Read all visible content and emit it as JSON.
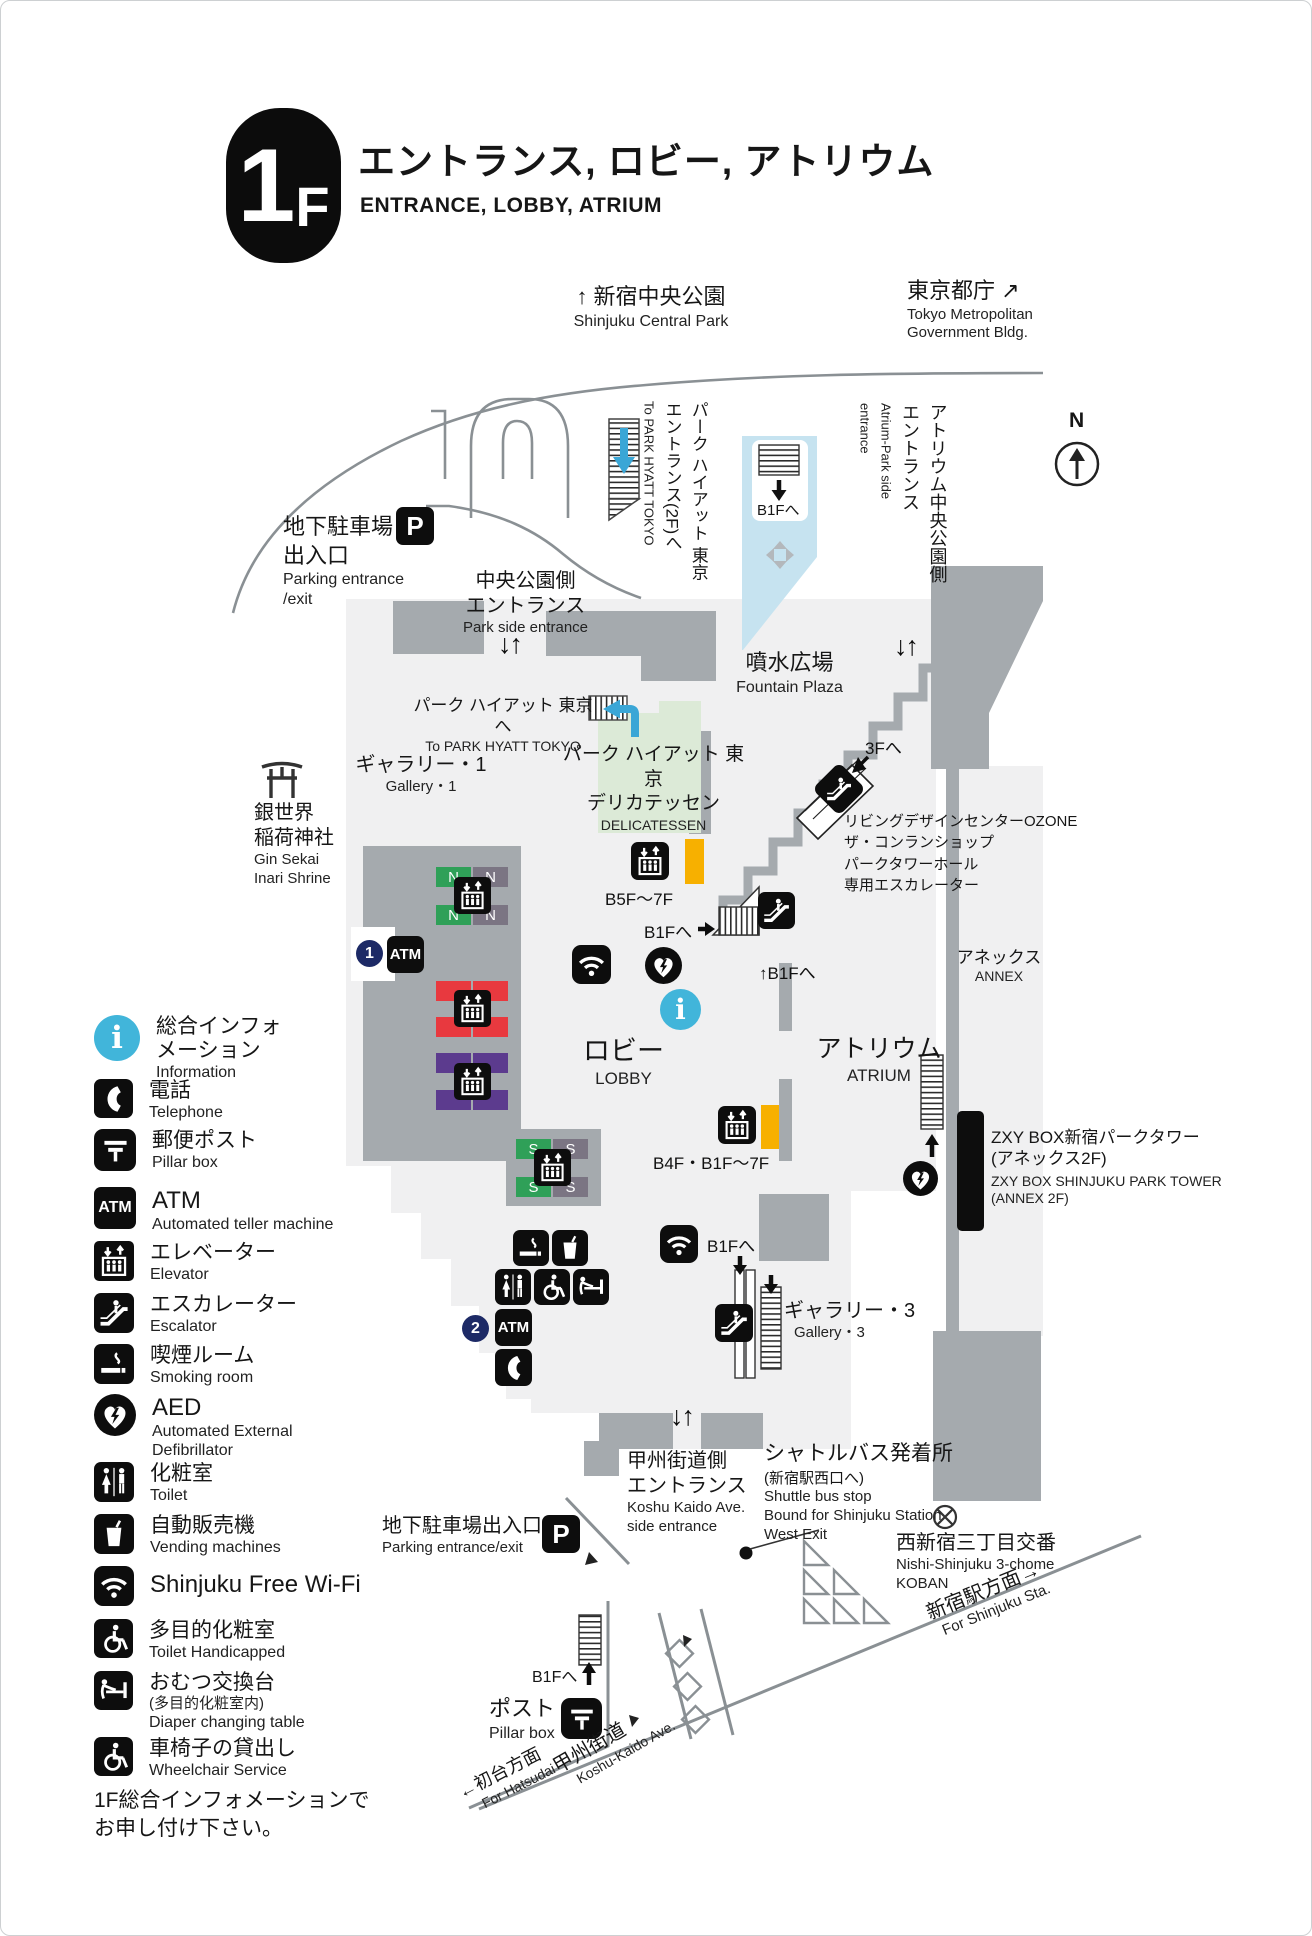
{
  "header": {
    "floor": "1F",
    "title_jp": "エントランス, ロビー, アトリウム",
    "title_en": "ENTRANCE, LOBBY, ATRIUM"
  },
  "compass": {
    "label": "N"
  },
  "top": {
    "park_jp": "↑ 新宿中央公園",
    "park_en": "Shinjuku Central Park",
    "tmg_jp": "東京都庁 ↗",
    "tmg_en1": "Tokyo Metropolitan",
    "tmg_en2": "Government Bldg."
  },
  "map": {
    "sym": {
      "p": "P",
      "atm": "ATM",
      "n": "N",
      "s": "S",
      "one": "1",
      "two": "2",
      "i": "i",
      "arrows": "↓↑",
      "right": "→",
      "up": "↑"
    },
    "parking_top": {
      "jp1": "地下駐車場",
      "jp2": "出入口",
      "en1": "Parking entrance",
      "en2": "/exit"
    },
    "park_side": {
      "jp1": "中央公園側",
      "jp2": "エントランス",
      "en": "Park side entrance"
    },
    "hyatt_vert": {
      "jp1": "パーク ハイアット 東京",
      "jp2": "エントランス(2F)へ",
      "en": "To PARK HYATT TOKYO"
    },
    "b1f_park": "B1Fへ",
    "atrium_vert": {
      "jp1": "アトリウム中央公園側",
      "jp2": "エントランス",
      "en1": "Atrium-Park side",
      "en2": "entrance"
    },
    "fountain": {
      "jp": "噴水広場",
      "en": "Fountain Plaza"
    },
    "hyatt_inline": {
      "jp": "パーク ハイアット 東京へ",
      "en": "To PARK HYATT TOKYO"
    },
    "gallery1": {
      "jp": "ギャラリー・1",
      "en": "Gallery・1"
    },
    "shrine": {
      "jp1": "銀世界",
      "jp2": "稲荷神社",
      "en1": "Gin Sekai",
      "en2": "Inari Shrine"
    },
    "deli": {
      "jp1": "パーク ハイアット 東京",
      "jp2": "デリカテッセン",
      "en": "DELICATESSEN"
    },
    "elev_b5f": "B5F〜7F",
    "b1f_deli": "B1Fへ",
    "b1f_deli_up": "↑B1Fへ",
    "f3": "3Fへ",
    "ozone": {
      "l1": "リビングデザインセンターOZONE",
      "l2": "ザ・コンランショップ",
      "l3": "パークタワーホール",
      "l4": "専用エスカレーター"
    },
    "annex": {
      "jp": "アネックス",
      "en": "ANNEX"
    },
    "lobby": {
      "jp": "ロビー",
      "en": "LOBBY"
    },
    "atrium": {
      "jp": "アトリウム",
      "en": "ATRIUM"
    },
    "zxy": {
      "jp1": "ZXY BOX新宿パークタワー",
      "jp2": "(アネックス2F)",
      "en1": "ZXY BOX SHINJUKU PARK TOWER",
      "en2": "(ANNEX 2F)"
    },
    "elev_b4f": "B4F・B1F〜7F",
    "b1f_lobby": "B1Fへ",
    "gallery3": {
      "jp": "ギャラリー・3",
      "en": "Gallery・3"
    },
    "koshu_entrance": {
      "jp1": "甲州街道側",
      "jp2": "エントランス",
      "en1": "Koshu Kaido Ave.",
      "en2": "side entrance"
    },
    "shuttle": {
      "jp1": "シャトルバス発着所",
      "jp2": "(新宿駅西口へ)",
      "en1": "Shuttle bus stop",
      "en2": "Bound for Shinjuku Station",
      "en3": "West Exit"
    },
    "koban": {
      "jp": "西新宿三丁目交番",
      "en1": "Nishi-Shinjuku 3-chome",
      "en2": "KOBAN"
    },
    "parking_bottom": {
      "jp": "地下駐車場出入口",
      "en": "Parking entrance/exit"
    },
    "b1f_road": "B1Fへ",
    "post": {
      "jp": "ポスト",
      "en": "Pillar box"
    },
    "shinjuku_sta": {
      "jp": "新宿駅方面→",
      "en": "For Shinjuku Sta."
    },
    "koshu_kaido": {
      "jp": "甲州街道",
      "en": "Koshu-Kaido Ave."
    },
    "hatsudai": {
      "jp": "←初台方面",
      "en": "For Hatsudai"
    }
  },
  "legend": {
    "items": [
      {
        "jp": "総合インフォ",
        "jp2": "メーション",
        "en": "Information"
      },
      {
        "jp": "電話",
        "en": "Telephone"
      },
      {
        "jp": "郵便ポスト",
        "en": "Pillar box"
      },
      {
        "jp": "ATM",
        "en": "Automated teller machine"
      },
      {
        "jp": "エレベーター",
        "en": "Elevator"
      },
      {
        "jp": "エスカレーター",
        "en": "Escalator"
      },
      {
        "jp": "喫煙ルーム",
        "en": "Smoking room"
      },
      {
        "jp": "AED",
        "en": "Automated External",
        "en2": "Defibrillator"
      },
      {
        "jp": "化粧室",
        "en": "Toilet"
      },
      {
        "jp": "自動販売機",
        "en": "Vending machines"
      },
      {
        "jp": "Shinjuku Free Wi-Fi",
        "en": ""
      },
      {
        "jp": "多目的化粧室",
        "en": "Toilet Handicapped"
      },
      {
        "jp": "おむつ交換台",
        "jp2": "(多目的化粧室内)",
        "en": "Diaper changing table"
      },
      {
        "jp": "車椅子の貸出し",
        "en": "Wheelchair Service"
      }
    ],
    "note1": "1F総合インフォメーションで",
    "note2": "お申し付け下さい。"
  }
}
